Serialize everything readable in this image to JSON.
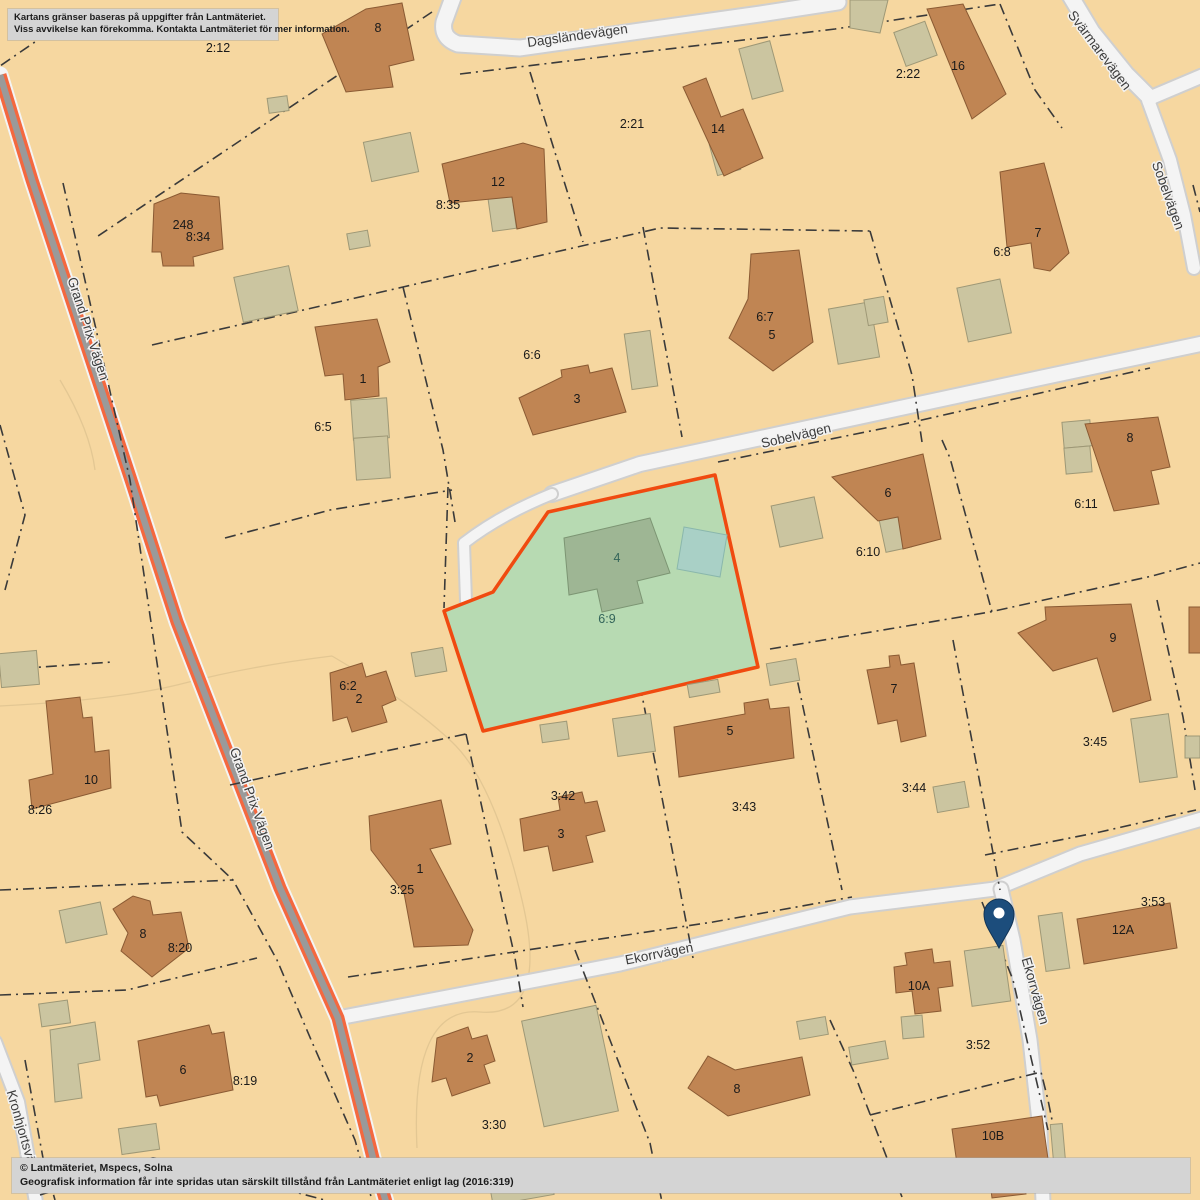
{
  "notices": {
    "top": {
      "line1": "Kartans gränser baseras på uppgifter från Lantmäteriet.",
      "line2": "Viss avvikelse kan förekomma. Kontakta Lantmäteriet för mer information."
    },
    "bottom": {
      "line1": "© Lantmäteriet, Mspecs, Solna",
      "line2": "Geografisk information får inte spridas utan särskilt tillstånd från Lantmäteriet enligt lag (2016:319)"
    }
  },
  "roads": {
    "labels": [
      {
        "text": "Dagsländevägen"
      },
      {
        "text": "Svärmarevägen"
      },
      {
        "text": "Sobelvägen"
      },
      {
        "text": "Sobelvägen"
      },
      {
        "text": "Grand Prix Vägen"
      },
      {
        "text": "Grand Prix Vägen"
      },
      {
        "text": "Ekorrvägen"
      },
      {
        "text": "Ekorrvägen"
      },
      {
        "text": "Kronhjortsvä"
      }
    ]
  },
  "highlight": {
    "parcel_id": "6:9",
    "building_label": "4",
    "fill": "#b7dab2",
    "border": "#f04a10"
  },
  "parcels": [
    {
      "id": "2:12"
    },
    {
      "id": "2:21"
    },
    {
      "id": "2:22"
    },
    {
      "id": "8:34"
    },
    {
      "id": "8:35"
    },
    {
      "id": "6:8"
    },
    {
      "id": "6:5"
    },
    {
      "id": "6:6"
    },
    {
      "id": "6:7"
    },
    {
      "id": "6:10"
    },
    {
      "id": "6:11"
    },
    {
      "id": "6:9"
    },
    {
      "id": "6:2"
    },
    {
      "id": "8:26"
    },
    {
      "id": "3:25"
    },
    {
      "id": "3:42"
    },
    {
      "id": "3:43"
    },
    {
      "id": "3:44"
    },
    {
      "id": "3:45"
    },
    {
      "id": "8:20"
    },
    {
      "id": "8:19"
    },
    {
      "id": "3:30"
    },
    {
      "id": "3:55"
    },
    {
      "id": "3:52"
    },
    {
      "id": "3:53"
    },
    {
      "id": "3:69"
    }
  ],
  "buildings": [
    {
      "label": "8"
    },
    {
      "label": "12"
    },
    {
      "label": "248"
    },
    {
      "label": "14"
    },
    {
      "label": "16"
    },
    {
      "label": "7"
    },
    {
      "label": "1"
    },
    {
      "label": "3"
    },
    {
      "label": "5"
    },
    {
      "label": "6"
    },
    {
      "label": "8"
    },
    {
      "label": "4"
    },
    {
      "label": "2"
    },
    {
      "label": "10"
    },
    {
      "label": "9"
    },
    {
      "label": "7"
    },
    {
      "label": "5"
    },
    {
      "label": "3"
    },
    {
      "label": "1"
    },
    {
      "label": "8"
    },
    {
      "label": "6"
    },
    {
      "label": "2"
    },
    {
      "label": "8"
    },
    {
      "label": "10A"
    },
    {
      "label": "12A"
    },
    {
      "label": "10B"
    }
  ],
  "colors": {
    "background": "#f6d7a0",
    "building": "#c08553",
    "building_outline": "#8a5a33",
    "outbuilding": "#cbc5a0",
    "outbuilding_outline": "#9e9876",
    "road_fill": "#f4f4f4",
    "road_casing": "#cfcfcf",
    "route_orange": "#f4683f",
    "route_gray": "#9a9a9a",
    "boundary": "#3a3a3a",
    "highlight_fill": "#b7dab2",
    "highlight_border": "#f04a10",
    "highlight_building": "#9eb694",
    "pool": "#a9d0c6",
    "pin": "#1c4d7c"
  }
}
